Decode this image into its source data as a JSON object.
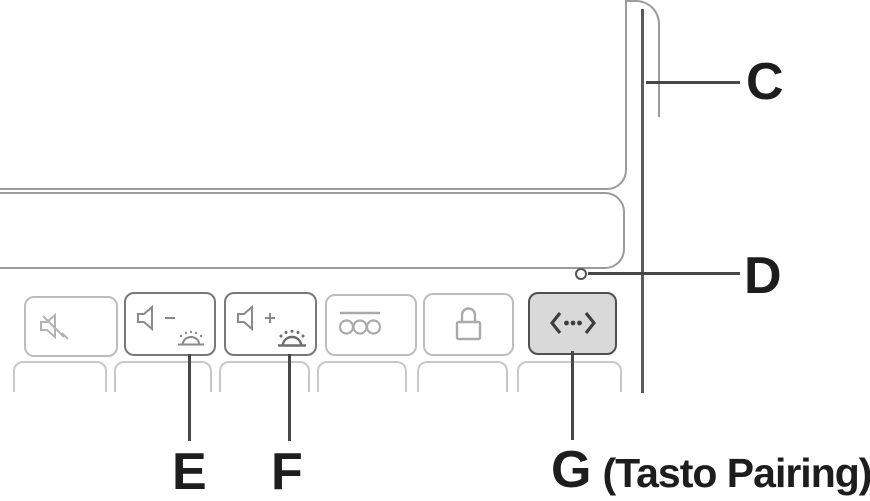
{
  "heading_fragment": "ts",
  "diagram_type": "keyboard-manual-callout-diagram",
  "callouts": {
    "c": {
      "label": "C",
      "points_to": "device-side-edge"
    },
    "d": {
      "label": "D",
      "points_to": "status-led"
    },
    "e": {
      "label": "E",
      "points_to": "volume-down-backlight-dim-key"
    },
    "f": {
      "label": "F",
      "points_to": "volume-up-backlight-bright-key"
    },
    "g": {
      "label": "G",
      "note": "(Tasto Pairing)",
      "points_to": "pairing-key"
    }
  },
  "keys": {
    "function_row": [
      {
        "name": "mute",
        "icons": [
          "speaker-mute-icon"
        ],
        "highlighted": false
      },
      {
        "name": "volume-down-backlight-dim",
        "icons": [
          "speaker-minus-icon",
          "backlight-dim-icon"
        ],
        "highlighted": false
      },
      {
        "name": "volume-up-backlight-bright",
        "icons": [
          "speaker-plus-icon",
          "backlight-bright-icon"
        ],
        "highlighted": false
      },
      {
        "name": "battery-check",
        "icons": [
          "three-circles-overline-icon"
        ],
        "highlighted": false
      },
      {
        "name": "lock",
        "icons": [
          "padlock-icon"
        ],
        "highlighted": false
      },
      {
        "name": "pairing",
        "icons": [
          "pairing-chevron-dots-icon"
        ],
        "highlighted": true
      }
    ],
    "second_row_partial_key_count": 6
  },
  "led": {
    "name": "status-led",
    "shape": "small-circle"
  },
  "colors": {
    "background": "#ffffff",
    "panel_outline": "#9b9b9b",
    "light_key_border": "#bdbdbd",
    "dark_key_border": "#787878",
    "highlight_key_fill": "#d9d9d9",
    "highlight_key_border": "#4f4f4f",
    "leader_line": "#474747",
    "label_text": "#1d1d1d"
  }
}
